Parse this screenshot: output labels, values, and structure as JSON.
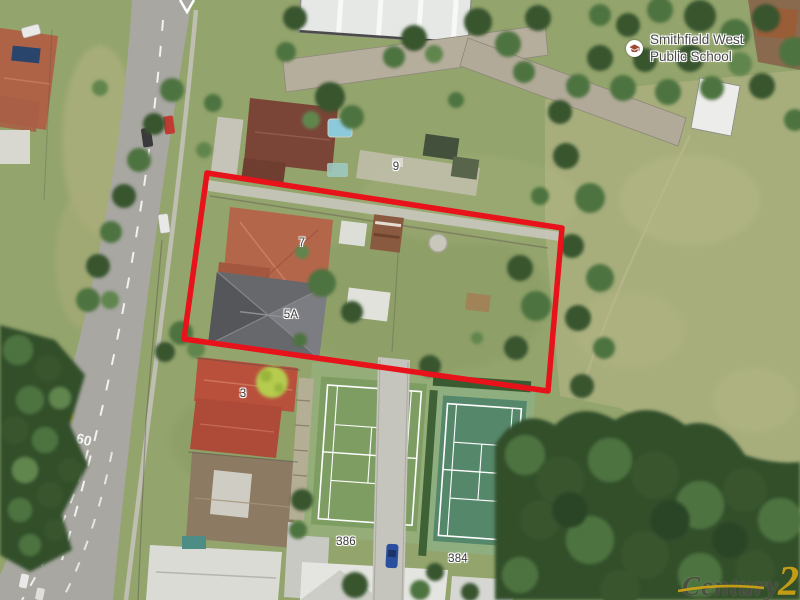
{
  "labels": {
    "school": {
      "line1": "Smithfield West",
      "line2": "Public School"
    },
    "house_numbers": [
      {
        "text": "9"
      },
      {
        "text": "7"
      },
      {
        "text": "5A"
      },
      {
        "text": "3"
      },
      {
        "text": "386"
      },
      {
        "text": "384"
      }
    ],
    "road_paint": "60"
  },
  "boundary": {
    "points": "207,173 562,228 548,391 184,339",
    "color": "#e8121a",
    "stroke_width": 5.5
  },
  "watermark": {
    "brand": "Century",
    "number": "21",
    "gold": "#d8a713",
    "text_color": "#4c4b42"
  },
  "colors": {
    "grass": "#93a46c",
    "dry_field": "#a7ae7c",
    "road": "#a8a7a1",
    "tree_dark": "#33502c",
    "roof_terracotta": "#b4664a",
    "roof_gray_5a": "#67686c",
    "roof_red_3": "#b8503c",
    "roof_brown_1": "#8d7a62",
    "tennis_court_green": "#7d9d63",
    "tennis_court_teal": "#55876b",
    "school_icon": "#9c4a38"
  }
}
